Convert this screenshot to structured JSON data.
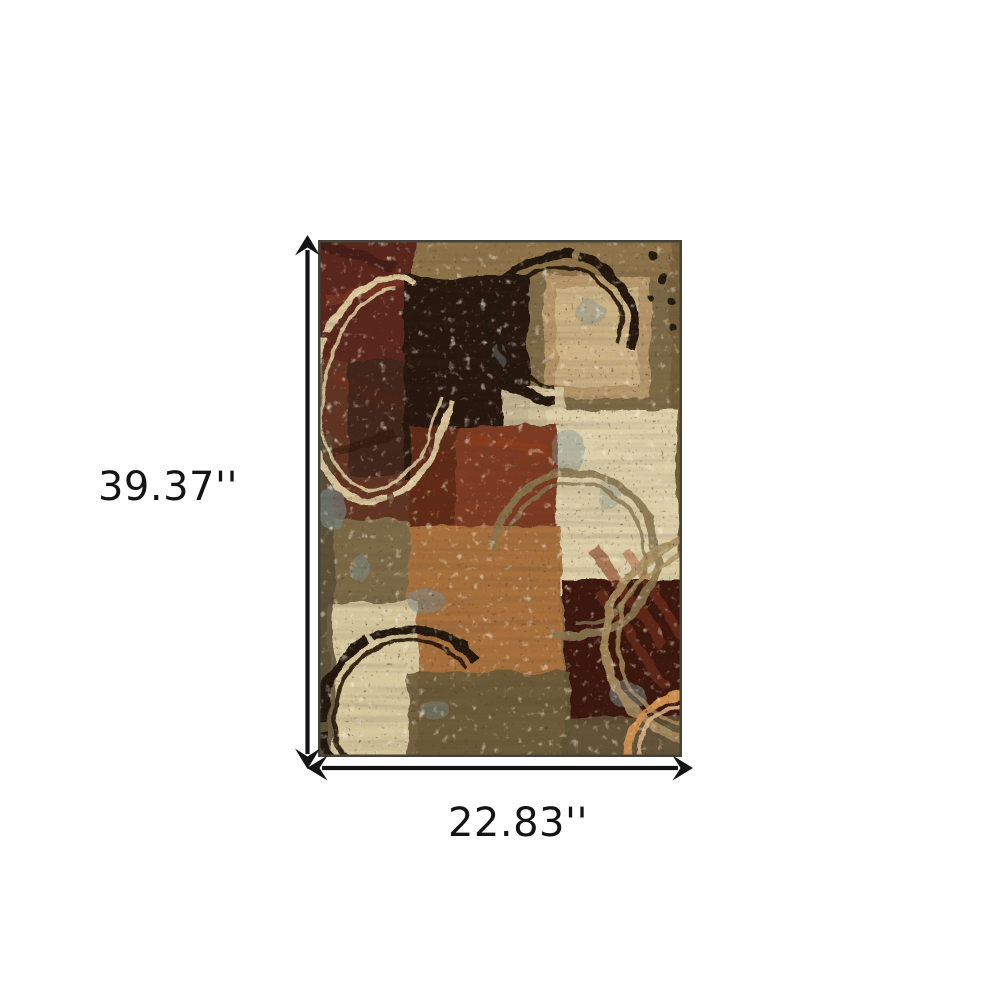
{
  "diagram": {
    "type": "product-dimensions",
    "product": "abstract-geometric-area-rug",
    "height_label": "39.37''",
    "width_label": "22.83''",
    "palette": {
      "page_background": "#ffffff",
      "dimension_lines": "#141414",
      "rug_background": "#7d6a46",
      "olive_strip": "#8d7448",
      "maroon": "#5a281a",
      "chocolate": "#281710",
      "tan_square": "#b6976a",
      "tan_inner": "#ccb384",
      "cream": "#ddcfa8",
      "cream_corner": "#d8c89e",
      "rust": "#7e3b20",
      "caramel": "#a86f3e",
      "maroon_streaked": "#3a190e",
      "blue_grey": "#7e9290",
      "ring_cream": "#d8c59a",
      "ring_dark": "#221307",
      "ring_olive": "#8a7750",
      "ring_tan": "#a98e62",
      "ring_orange": "#cf9050"
    }
  }
}
